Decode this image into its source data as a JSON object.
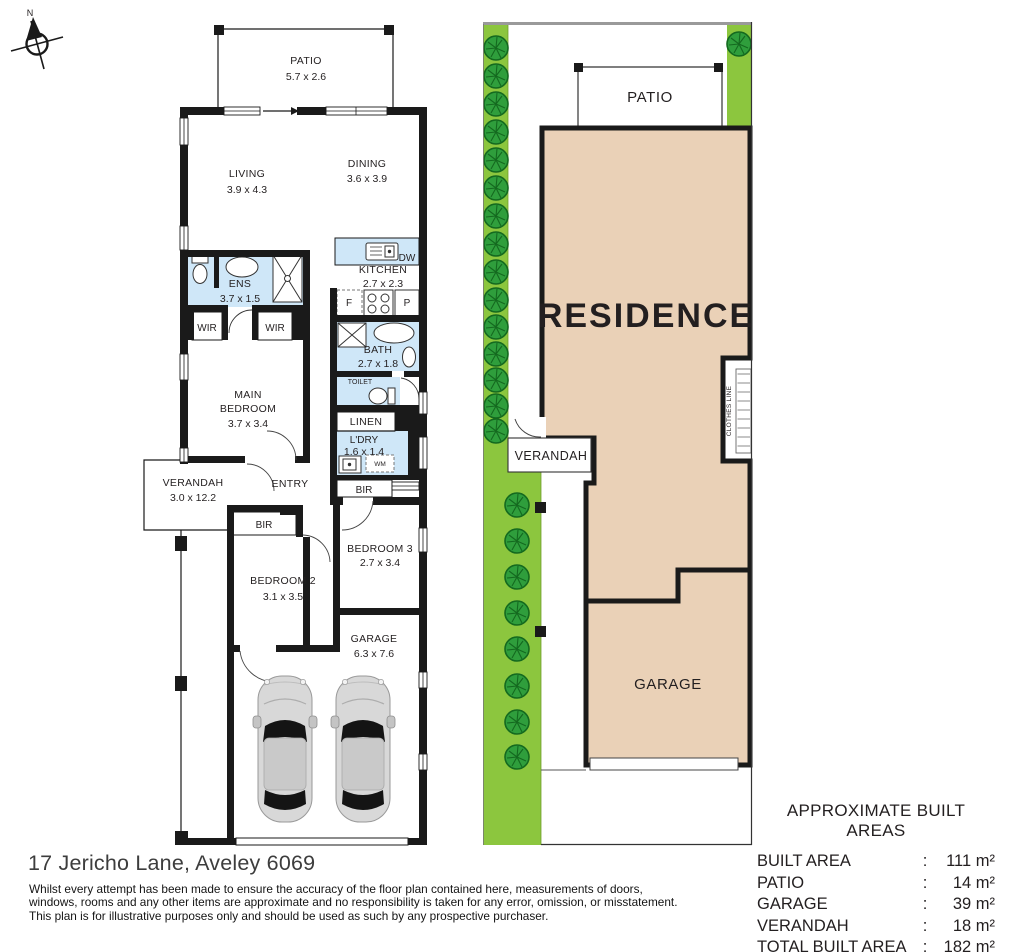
{
  "address": "17 Jericho Lane, Aveley 6069",
  "disclaimer": {
    "line1": "Whilst every attempt has been made to ensure the accuracy of the floor plan contained here, measurements of doors,",
    "line2": "windows, rooms and any other items are approximate and no responsibility is taken for any error, omission, or misstatement.",
    "line3": "This plan is for illustrative purposes only and should be used as such by any prospective purchaser."
  },
  "compass": {
    "north": "N"
  },
  "floorplan": {
    "patio": {
      "label": "PATIO",
      "dims": "5.7 x 2.6"
    },
    "living": {
      "label": "LIVING",
      "dims": "3.9 x 4.3"
    },
    "dining": {
      "label": "DINING",
      "dims": "3.6 x 3.9"
    },
    "kitchen": {
      "label": "KITCHEN",
      "dims": "2.7 x 2.3"
    },
    "ens": {
      "label": "ENS",
      "dims": "3.7 x 1.5"
    },
    "bath": {
      "label": "BATH",
      "dims": "2.7 x 1.8"
    },
    "main_bedroom": {
      "label1": "MAIN",
      "label2": "BEDROOM",
      "dims": "3.7 x 3.4"
    },
    "bedroom2": {
      "label": "BEDROOM 2",
      "dims": "3.1 x 3.5"
    },
    "bedroom3": {
      "label": "BEDROOM 3",
      "dims": "2.7 x 3.4"
    },
    "garage": {
      "label": "GARAGE",
      "dims": "6.3 x 7.6"
    },
    "verandah": {
      "label": "VERANDAH",
      "dims": "3.0 x 12.2"
    },
    "laundry": {
      "label": "L'DRY",
      "dims": "1.6 x 1.4"
    },
    "labels": {
      "entry": "ENTRY",
      "linen": "LINEN",
      "toilet": "TOILET",
      "wir_left": "WIR",
      "wir_right": "WIR",
      "bir_hall": "BIR",
      "bir_bed2": "BIR",
      "dishwasher": "DW",
      "fridge": "F",
      "pantry": "P",
      "washing_machine": "WM"
    }
  },
  "siteplan": {
    "patio": "PATIO",
    "residence": "RESIDENCE",
    "verandah": "VERANDAH",
    "garage": "GARAGE",
    "clothes_line": "CLOTHES LINE"
  },
  "areas_table": {
    "title": "APPROXIMATE BUILT AREAS",
    "separator": ":",
    "rows": [
      {
        "label": "BUILT AREA",
        "value": "111 m²"
      },
      {
        "label": "PATIO",
        "value": "14 m²"
      },
      {
        "label": "GARAGE",
        "value": "39 m²"
      },
      {
        "label": "VERANDAH",
        "value": "18 m²"
      },
      {
        "label": "TOTAL BUILT AREA",
        "value": "182 m²"
      }
    ]
  },
  "colors": {
    "wall": "#1a1a1a",
    "wet_area_blue": "#cfe7f8",
    "residence_tan": "#ead1b7",
    "garden_green": "#8cc63e",
    "tree_green": "#2f9e3c",
    "boundary_gray": "#9a9a9a"
  }
}
